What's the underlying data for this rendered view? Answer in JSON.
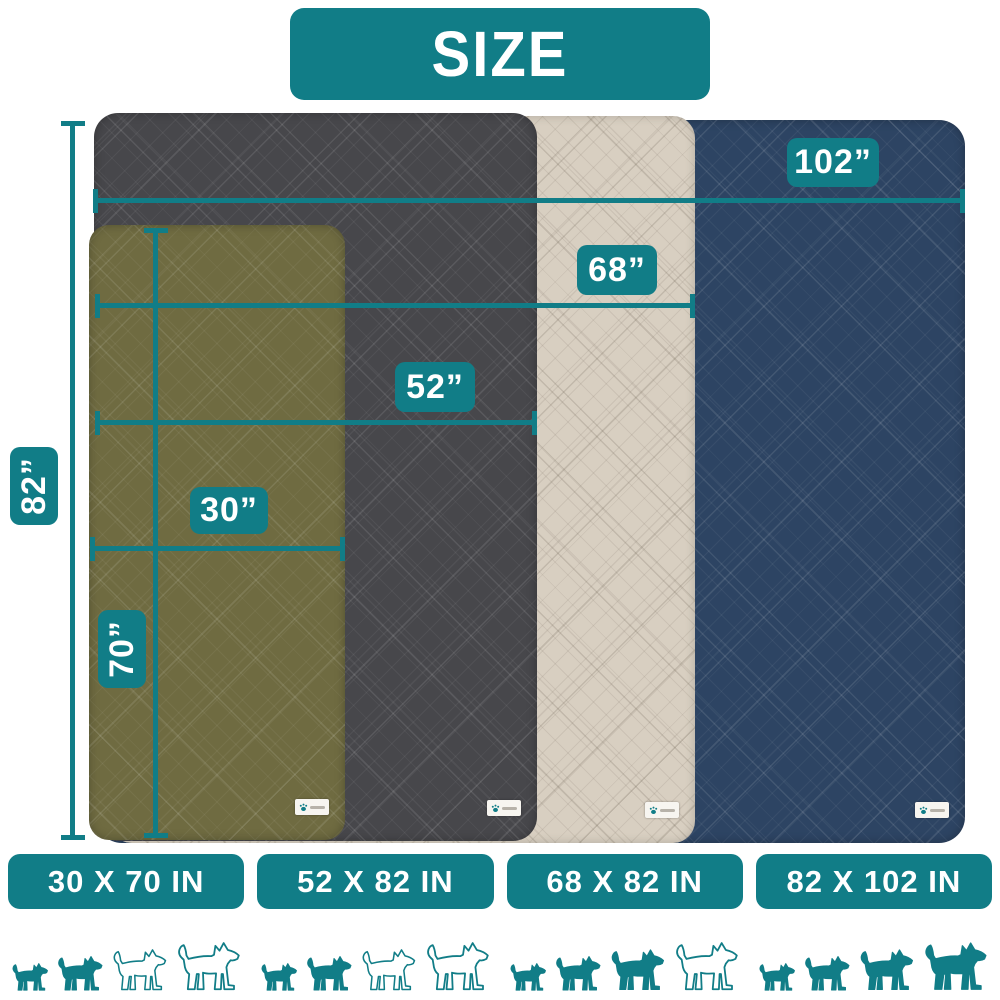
{
  "title": "SIZE",
  "colors": {
    "teal": "#117d87",
    "olive": "#6f6b41",
    "gray": "#47474b",
    "beige": "#d8cfc1",
    "navy": "#2d4463"
  },
  "measurements": {
    "navy_width": "102”",
    "beige_width": "68”",
    "gray_width": "52”",
    "olive_width": "30”",
    "common_height": "82”",
    "olive_height": "70”"
  },
  "blankets": [
    {
      "id": "olive",
      "color_name": "olive green",
      "size_label": "30 X 70 IN",
      "width_in": 30,
      "length_in": 70
    },
    {
      "id": "gray",
      "color_name": "dark gray",
      "size_label": "52 X 82 IN",
      "width_in": 52,
      "length_in": 82
    },
    {
      "id": "beige",
      "color_name": "beige",
      "size_label": "68 X 82 IN",
      "width_in": 68,
      "length_in": 82
    },
    {
      "id": "navy",
      "color_name": "navy blue",
      "size_label": "82 X 102 IN",
      "width_in": 82,
      "length_in": 102
    }
  ],
  "size_cards": [
    {
      "label": "30 X 70 IN",
      "dogs_filled": [
        true,
        true,
        false,
        false
      ]
    },
    {
      "label": "52 X 82 IN",
      "dogs_filled": [
        true,
        true,
        false,
        false
      ]
    },
    {
      "label": "68 X 82 IN",
      "dogs_filled": [
        true,
        true,
        true,
        false
      ]
    },
    {
      "label": "82 X 102 IN",
      "dogs_filled": [
        true,
        true,
        true,
        true
      ]
    }
  ],
  "tag": {
    "icon": "paw-icon"
  }
}
